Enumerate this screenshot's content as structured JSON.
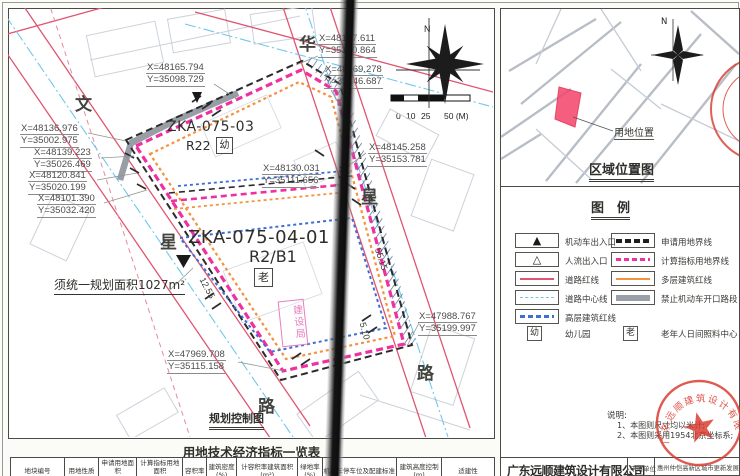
{
  "drawing": {
    "streets": {
      "left": [
        "文",
        "星",
        "路"
      ],
      "right": [
        "华",
        "星",
        "路"
      ]
    },
    "parcels": {
      "north": {
        "code": "ZKA-075-03",
        "use_label": "R22",
        "facility": "幼"
      },
      "south": {
        "code": "ZKA-075-04-01",
        "use_label": "R2/B1",
        "facility": "老"
      }
    },
    "note_unified": "须统一规划面积1027m²",
    "stamp_pink": "建设局",
    "drawing_title": "规划控制图",
    "dimensions": [
      "12.55",
      "55.15",
      "5.10"
    ],
    "north_label": "N",
    "scale_labels": [
      "0",
      "10",
      "25",
      "50 (M)"
    ],
    "coords": [
      {
        "x": "X=48165.794",
        "y": "Y=35098.729"
      },
      {
        "x": "X=48177.611",
        "y": "Y=35130.864"
      },
      {
        "x": "X=48169.278",
        "y": "Y=35146.687"
      },
      {
        "x": "X=48145.258",
        "y": "Y=35153.781"
      },
      {
        "x": "X=48136.976",
        "y": "Y=35002.975"
      },
      {
        "x": "X=48139.223",
        "y": "Y=35026.469"
      },
      {
        "x": "X=48120.841",
        "y": "Y=35020.199"
      },
      {
        "x": "X=48101.390",
        "y": "Y=35032.420"
      },
      {
        "x": "X=48130.031",
        "y": "Y=35111.656"
      },
      {
        "x": "X=47988.767",
        "y": "Y=35199.997"
      },
      {
        "x": "X=47969.708",
        "y": "Y=35115.158"
      }
    ]
  },
  "location_map": {
    "title": "区域位置图",
    "site_label": "用地位置",
    "north_label": "N"
  },
  "legend": {
    "title": "图　例",
    "left": [
      {
        "label": "机动车出入口"
      },
      {
        "label": "人流出入口"
      },
      {
        "label": "道路红线"
      },
      {
        "label": "道路中心线"
      },
      {
        "label": "高层建筑红线"
      },
      {
        "symbol_char": "幼",
        "label": "幼儿园"
      }
    ],
    "right": [
      {
        "label": "申请用地界线"
      },
      {
        "label": "计算指标用地界线"
      },
      {
        "label": "多层建筑红线"
      },
      {
        "label": "禁止机动车开口路段"
      },
      {
        "symbol_char": "老",
        "label": "老年人日间照料中心"
      }
    ]
  },
  "notes": {
    "title": "说明:",
    "lines": [
      "1、本图则尺寸均以米计;",
      "2、本图则采用1954北京坐标系;"
    ]
  },
  "title_block": {
    "company": "广东远顺建筑设计有限公司",
    "applicant_label": "申请单位",
    "applicant": "惠州仲恺高新区城市更新发展中心"
  },
  "stamp": {
    "company": "广东远顺建筑设计有限公司"
  },
  "table": {
    "title": "用地技术经济指标一览表",
    "columns": [
      {
        "t": "地块编号",
        "s": ""
      },
      {
        "t": "用地性质",
        "s": ""
      },
      {
        "t": "申请用地面积",
        "s": "(m²)"
      },
      {
        "t": "计算指标用地面积",
        "s": "(m²)"
      },
      {
        "t": "容积率",
        "s": ""
      },
      {
        "t": "建筑密度",
        "s": "(%)"
      },
      {
        "t": "计容积率建筑面积",
        "s": "(m²)"
      },
      {
        "t": "绿地率",
        "s": "(%)"
      },
      {
        "t": "机动车停车位及配建标准",
        "s": ""
      },
      {
        "t": "建筑高度控制(m)",
        "s": ""
      },
      {
        "t": "适建性",
        "s": ""
      }
    ]
  },
  "colors": {
    "boundary_application": "#2b2b2b",
    "boundary_index": "#ee30a0",
    "road_redline": "#e05570",
    "road_centerline": "#70c8ec",
    "multi_storey_redline": "#f5923e",
    "highrise_redline": "#3d6ed6",
    "no_vehicle_opening": "#8e949c",
    "stamp_red": "#d8392c",
    "site_fill": "#f4486e"
  }
}
